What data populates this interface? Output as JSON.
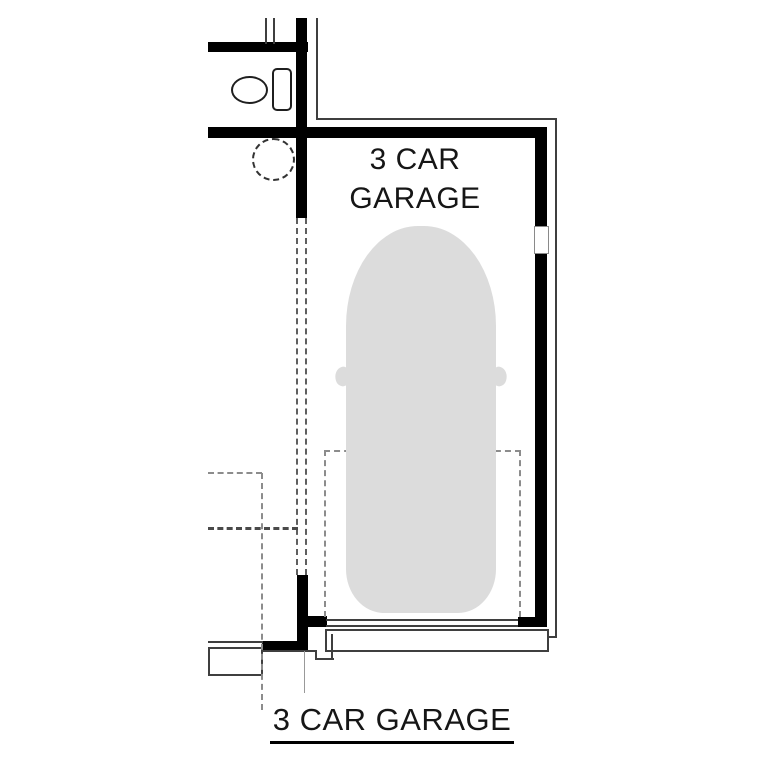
{
  "plan": {
    "room_label_line1": "3 CAR",
    "room_label_line2": "GARAGE",
    "caption": "3 CAR GARAGE",
    "colors": {
      "background": "#ffffff",
      "wall": "#000000",
      "thin_line": "#3f3f3f",
      "mid_line": "#5f5f5f",
      "dash_line": "#8c8c8c",
      "car_fill": "#dcdcdc",
      "fixture_line": "#1f1f1f",
      "text": "#161616"
    }
  }
}
